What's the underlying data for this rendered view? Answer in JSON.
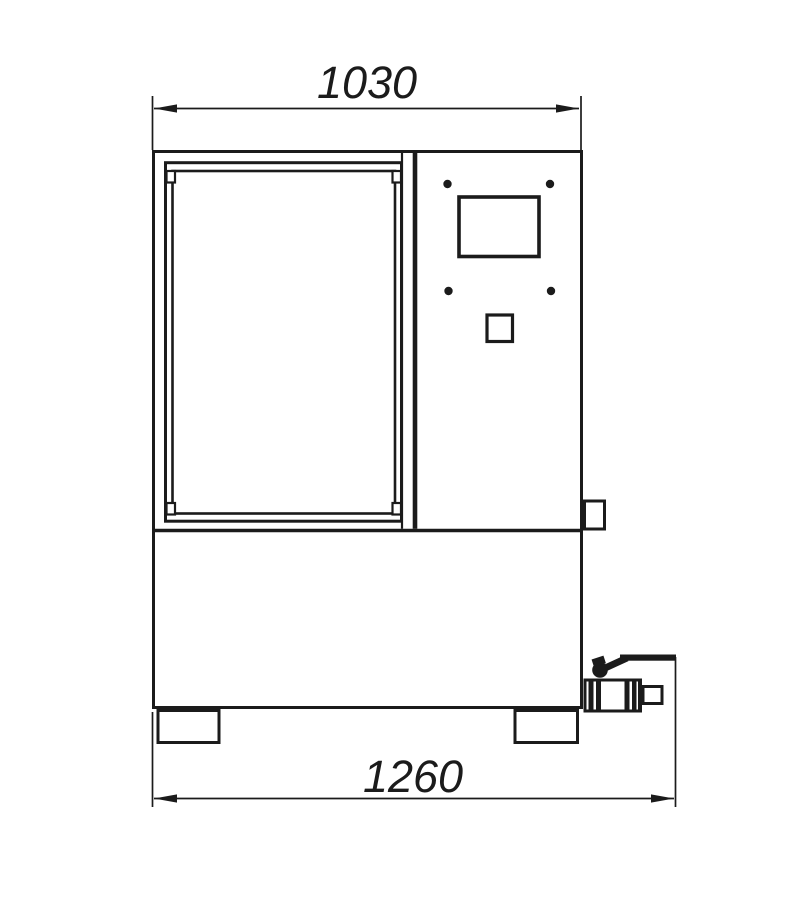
{
  "dimension_labels": {
    "top": "1030",
    "bottom": "1260"
  },
  "colors": {
    "line": "#1b1b1b",
    "background": "#ffffff"
  }
}
